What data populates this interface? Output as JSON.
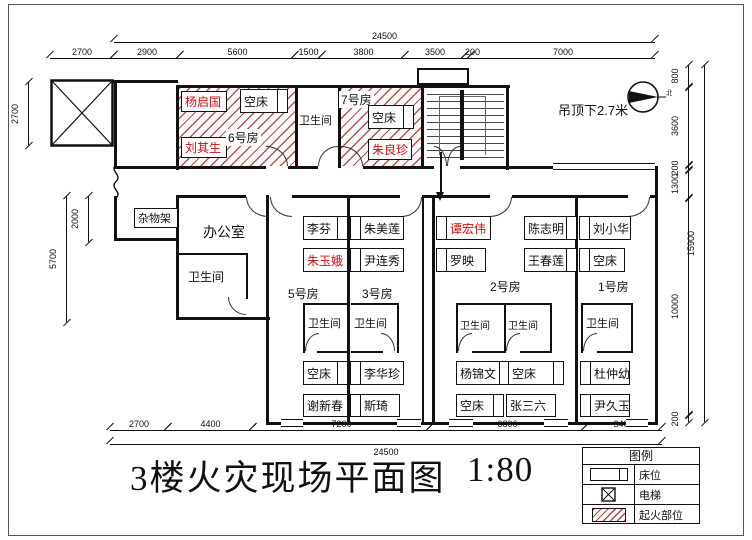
{
  "drawing": {
    "title": "3楼火灾现场平面图",
    "scale": "1:80",
    "ceiling_note": "吊顶下2.7米",
    "north_label": "北"
  },
  "legend": {
    "title": "图例",
    "items": [
      {
        "symbol": "bed-symbol",
        "label": "床位"
      },
      {
        "symbol": "elevator-symbol",
        "label": "电梯"
      },
      {
        "symbol": "fire-origin-symbol",
        "label": "起火部位"
      }
    ]
  },
  "labels": {
    "bathroom": "卫生间",
    "office": "办公室",
    "shelf": "杂物架"
  },
  "colors": {
    "wall": "#111111",
    "fire_hatch": "#b23030",
    "victim_text": "#cc1111",
    "normal_text": "#111111"
  },
  "rooms": {
    "r6": {
      "label": "6号房",
      "fire": true,
      "beds": [
        {
          "name": "杨启国",
          "color": "#cc1111"
        },
        {
          "name": "空床",
          "color": "#111111"
        },
        {
          "name": "刘其生",
          "color": "#cc1111"
        }
      ]
    },
    "r7": {
      "label": "7号房",
      "fire": true,
      "beds": [
        {
          "name": "空床",
          "color": "#111111"
        },
        {
          "name": "朱良珍",
          "color": "#cc1111"
        }
      ]
    },
    "r5": {
      "label": "5号房",
      "fire": false,
      "beds": [
        {
          "name": "李芬",
          "color": "#111111"
        },
        {
          "name": "朱玉娥",
          "color": "#cc1111"
        },
        {
          "name": "空床",
          "color": "#111111"
        },
        {
          "name": "谢新春",
          "color": "#111111"
        }
      ]
    },
    "r3": {
      "label": "3号房",
      "fire": false,
      "beds": [
        {
          "name": "朱美莲",
          "color": "#111111"
        },
        {
          "name": "尹连秀",
          "color": "#111111"
        },
        {
          "name": "李华珍",
          "color": "#111111"
        },
        {
          "name": "斯琦",
          "color": "#111111"
        }
      ]
    },
    "r2": {
      "label": "2号房",
      "fire": false,
      "beds": [
        {
          "name": "谭宏伟",
          "color": "#cc1111"
        },
        {
          "name": "罗映",
          "color": "#111111"
        },
        {
          "name": "陈志明",
          "color": "#111111"
        },
        {
          "name": "王春莲",
          "color": "#111111"
        },
        {
          "name": "杨锦文",
          "color": "#111111"
        },
        {
          "name": "空床",
          "color": "#111111"
        },
        {
          "name": "空床",
          "color": "#111111"
        },
        {
          "name": "张三六",
          "color": "#111111"
        }
      ]
    },
    "r1": {
      "label": "1号房",
      "fire": false,
      "beds": [
        {
          "name": "刘小华",
          "color": "#111111"
        },
        {
          "name": "空床",
          "color": "#111111"
        },
        {
          "name": "杜仲幼",
          "color": "#111111"
        },
        {
          "name": "尹久玉",
          "color": "#111111"
        }
      ]
    }
  },
  "dims": {
    "top_overall": "24500",
    "top": [
      "2700",
      "2900",
      "5600",
      "1500",
      "3800",
      "3500",
      "200",
      "7000"
    ],
    "bottom": [
      "2700",
      "4400",
      "7200",
      "6800",
      "3400"
    ],
    "bottom_overall": "24500",
    "left": [
      "2700",
      "2000",
      "5700"
    ],
    "right": [
      "800",
      "3600",
      "200",
      "1300",
      "10000",
      "200"
    ],
    "right_overall": "15900"
  }
}
